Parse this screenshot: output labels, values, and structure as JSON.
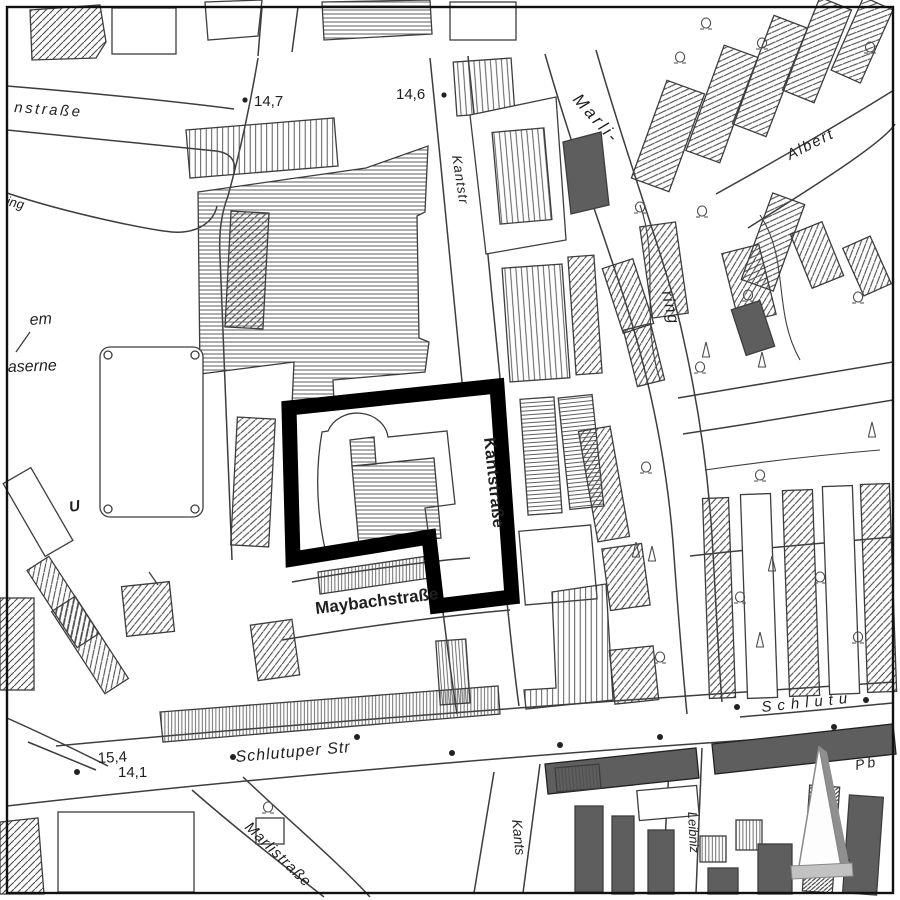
{
  "labels": {
    "nstrasse": "nstraße",
    "ing": "ing",
    "em": "em",
    "aserne": "aserne",
    "u": "U",
    "kantstr": "Kantstr",
    "marli": "Marli-",
    "ring": "ring",
    "albert": "Albert",
    "kantstrasse_bold": "Kantstraße",
    "maybachstrasse_bold": "Maybachstraße",
    "schlutuper_str": "Schlutuper Str",
    "schlutu": "Schlutu",
    "marlistrasse": "Marlistraße",
    "kants": "Kants",
    "leibniz": "Leibniz",
    "pb": "Pb",
    "sche": "sch"
  },
  "elevations": {
    "p147": "14,7",
    "p146": "14,6",
    "p154": "15,4",
    "p141": "14,1"
  },
  "icons": {
    "north_arrow": "north-arrow (up triangle with shadow)",
    "tree_deciduous": "omega tree symbol",
    "tree_conifer": "conifer symbol",
    "elevation_dot": "filled point marker"
  },
  "colors": {
    "background": "#ffffff",
    "ink": "#1f1f1f",
    "line": "#3d3d3d",
    "hatch": "#4a4a4a",
    "dark_building": "#5e5e5e",
    "boundary": "#000000",
    "arrow_shadow": "#8f8f8f",
    "arrow_base": "#c2c2c2"
  }
}
